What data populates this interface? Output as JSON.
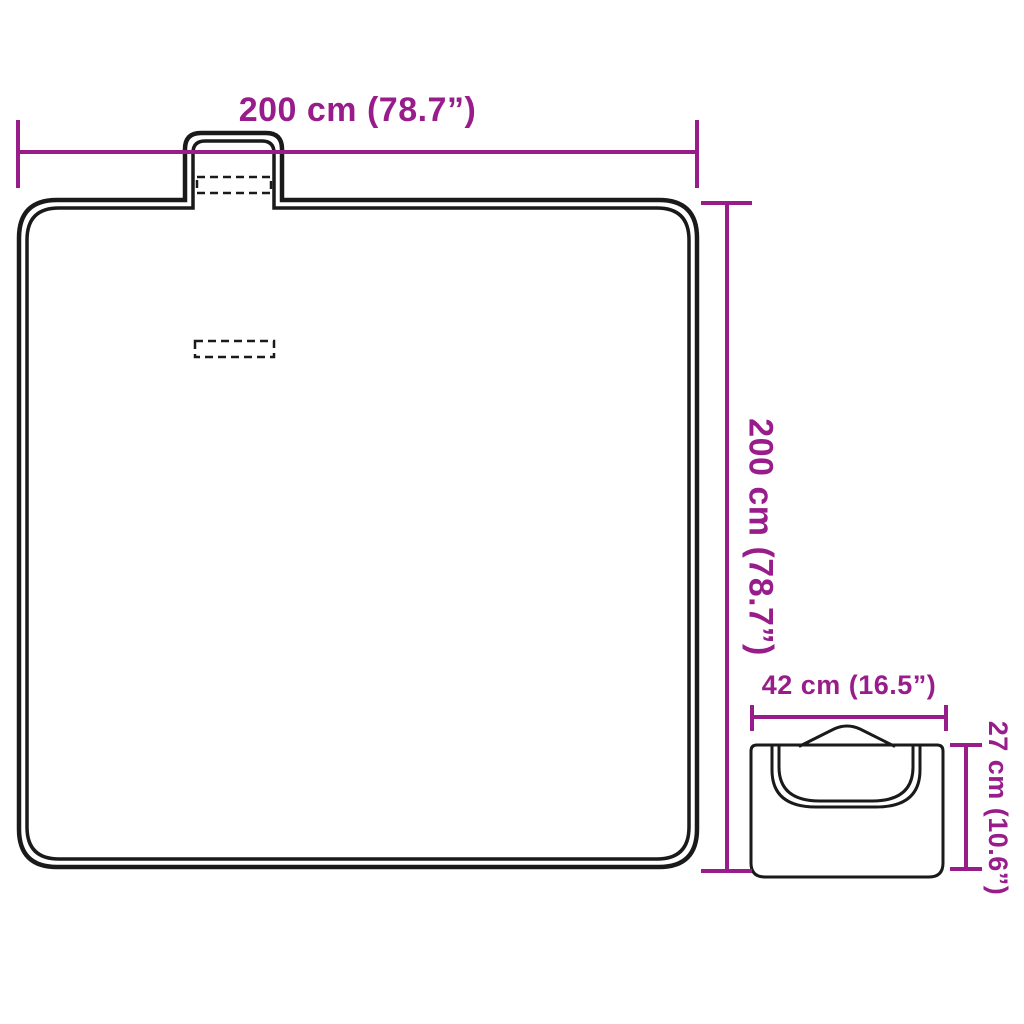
{
  "colors": {
    "background": "#ffffff",
    "dimension": "#981D8B",
    "outline": "#1a1a1a"
  },
  "diagram": {
    "unfolded_blanket": {
      "width_label": "200 cm (78.7”)",
      "height_label": "200 cm (78.7”)"
    },
    "folded_blanket": {
      "width_label": "42 cm (16.5”)",
      "height_label": "27 cm (10.6”)"
    }
  }
}
